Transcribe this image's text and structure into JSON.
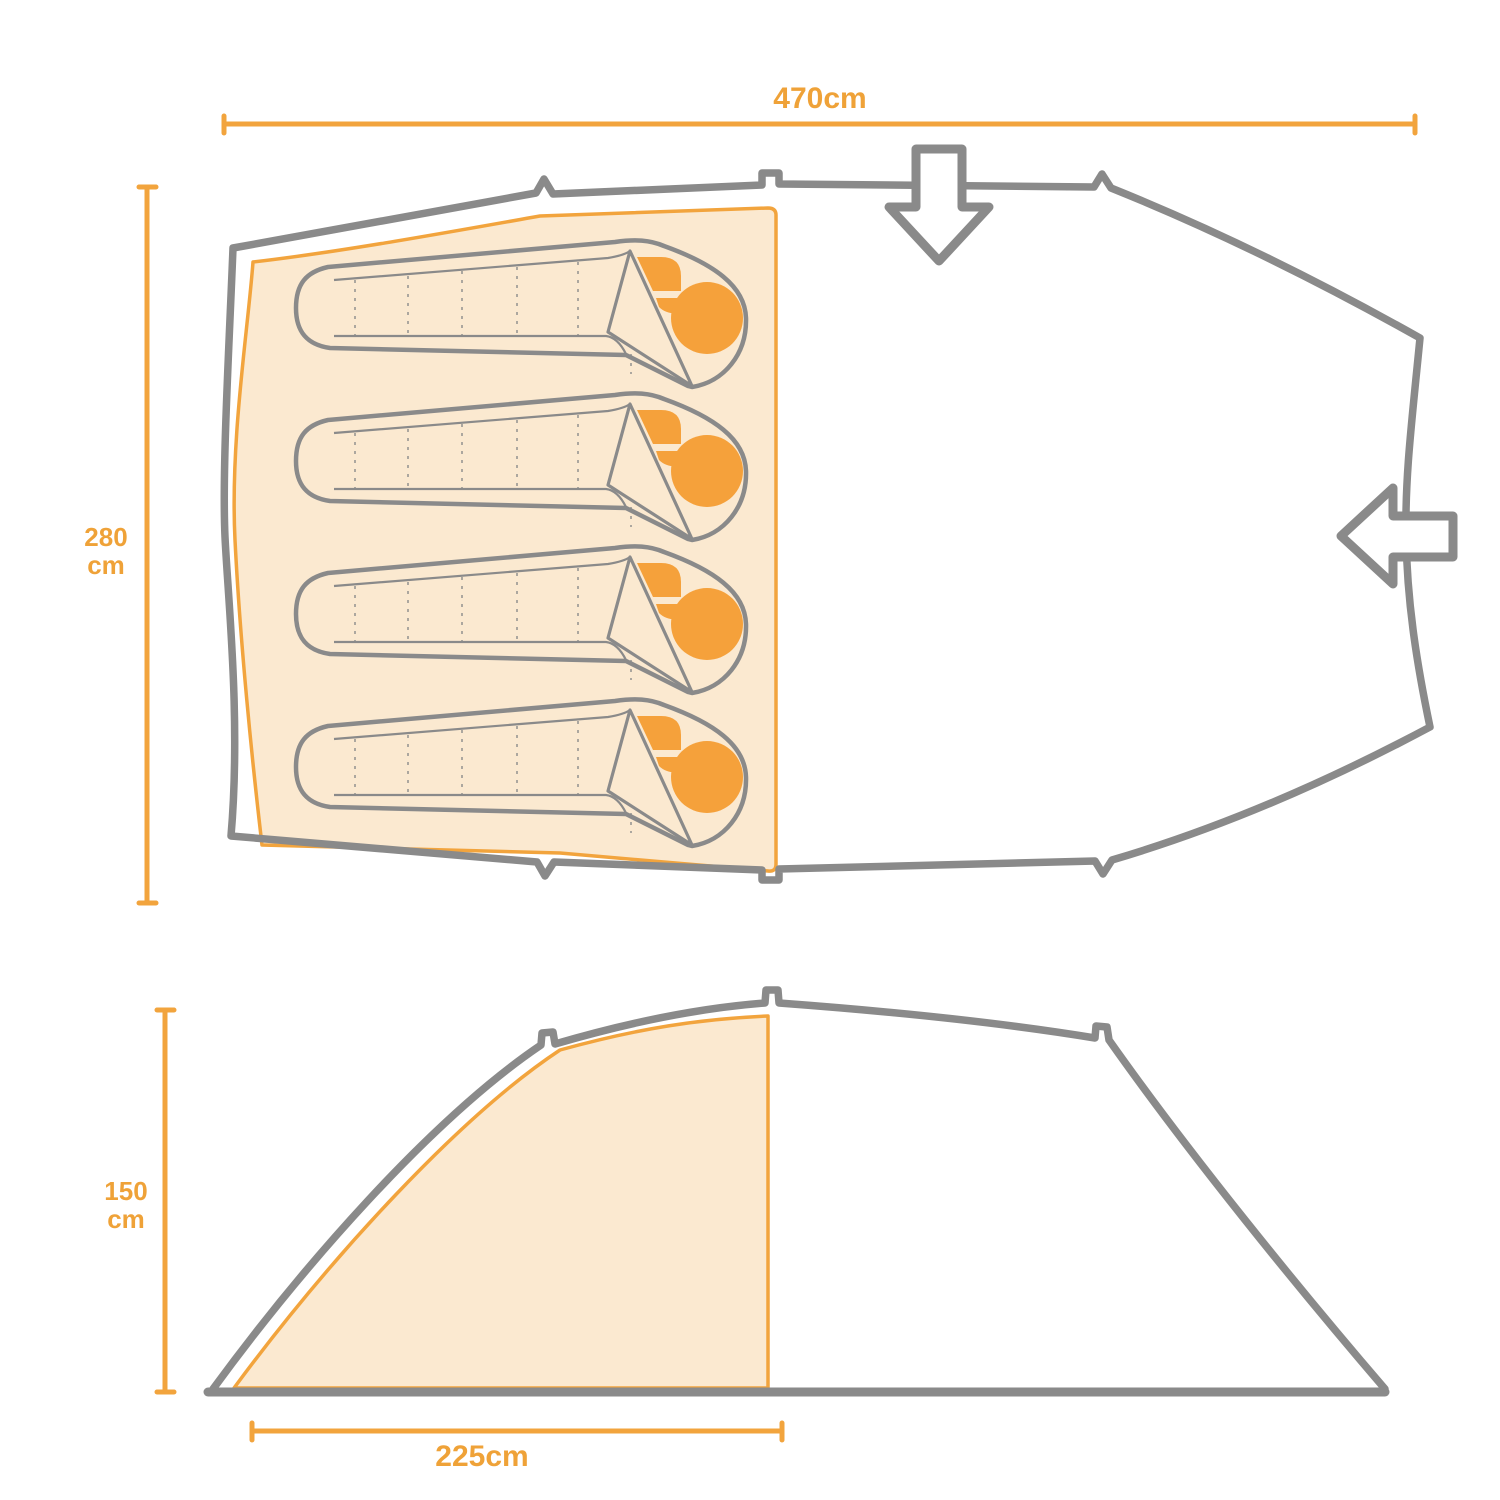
{
  "diagram": {
    "type": "tent-dimensions-diagram",
    "views": {
      "top_view": {
        "name": "floorplan-top-view",
        "sleeping_bags_count": 4,
        "width_label": "470cm",
        "depth_label_value": "280",
        "depth_label_unit": "cm",
        "door_icons": [
          "arrow-down-icon",
          "arrow-left-icon"
        ]
      },
      "side_view": {
        "name": "side-profile-view",
        "height_label_value": "150",
        "height_label_unit": "cm",
        "sleeping_area_label": "225cm"
      }
    }
  },
  "labels": {
    "width_top": "470cm",
    "depth_value": "280",
    "depth_unit": "cm",
    "height_value": "150",
    "height_unit": "cm",
    "sleep_depth": "225cm"
  },
  "colors": {
    "accent": "#F2A43D",
    "label": "#EFA238",
    "outline": "#8A8A8A",
    "fill": "#FBE9D0",
    "bright": "#F5A13B",
    "background": "#FFFFFF"
  }
}
